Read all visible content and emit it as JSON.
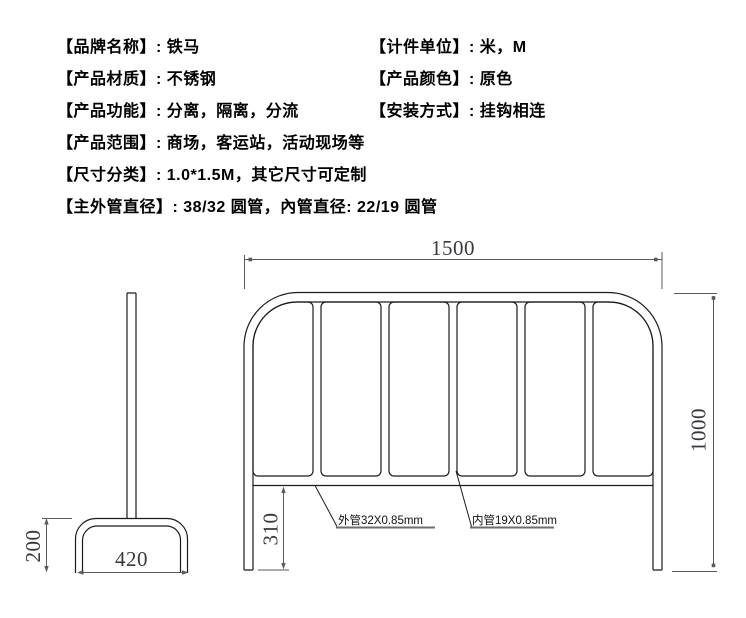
{
  "specs": {
    "lines": [
      {
        "col1": "【品牌名称】: 铁马",
        "col2": "【计件单位】: 米，M"
      },
      {
        "col1": "【产品材质】: 不锈钢",
        "col2": "【产品颜色】: 原色"
      },
      {
        "col1": "【产品功能】: 分离，隔离，分流",
        "col2": "【安装方式】: 挂钩相连"
      },
      {
        "col1": "【产品范围】: 商场，客运站，活动现场等",
        "col2": ""
      },
      {
        "col1": "【尺寸分类】: 1.0*1.5M，其它尺寸可定制",
        "col2": ""
      },
      {
        "col1": "【主外管直径】: 38/32 圆管，內管直径: 22/19 圆管",
        "col2": ""
      }
    ]
  },
  "diagram": {
    "front_view": {
      "width_label": "1500",
      "height_label": "1000",
      "leg_height_label": "310",
      "outer_tube_label": "外管32X0.85mm",
      "inner_tube_label": "内管19X0.85mm"
    },
    "side_view": {
      "foot_height_label": "200",
      "foot_width_label": "420"
    },
    "colors": {
      "geometry": "#1c1c1c",
      "dimension": "#5a5a5a",
      "dim_text": "#38383f",
      "underline": "#6e6e6e"
    }
  }
}
